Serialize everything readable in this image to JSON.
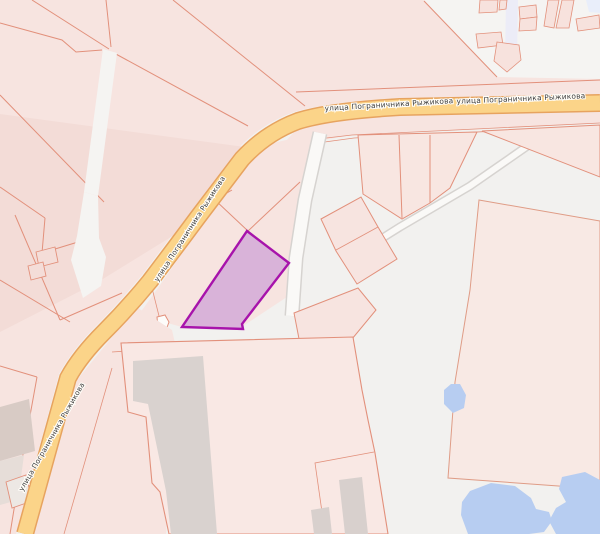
{
  "map": {
    "street_label": "улица Пограничника Рыжикова",
    "colors": {
      "background": "#f2f1ef",
      "parcel_fill": "#f7e4e0",
      "parcel_border": "#e2907b",
      "road_fill": "#fbd489",
      "road_casing": "#e7a35f",
      "highlight_fill": "#d9b3d9",
      "highlight_border": "#a713ab",
      "water": "#b7cdf1",
      "building_gray": "#d9d2cf",
      "path_fill": "#faf9f7",
      "path_casing": "#d6d3d0",
      "label_color": "#3d3d3d",
      "label_halo": "#fffdf8"
    }
  }
}
